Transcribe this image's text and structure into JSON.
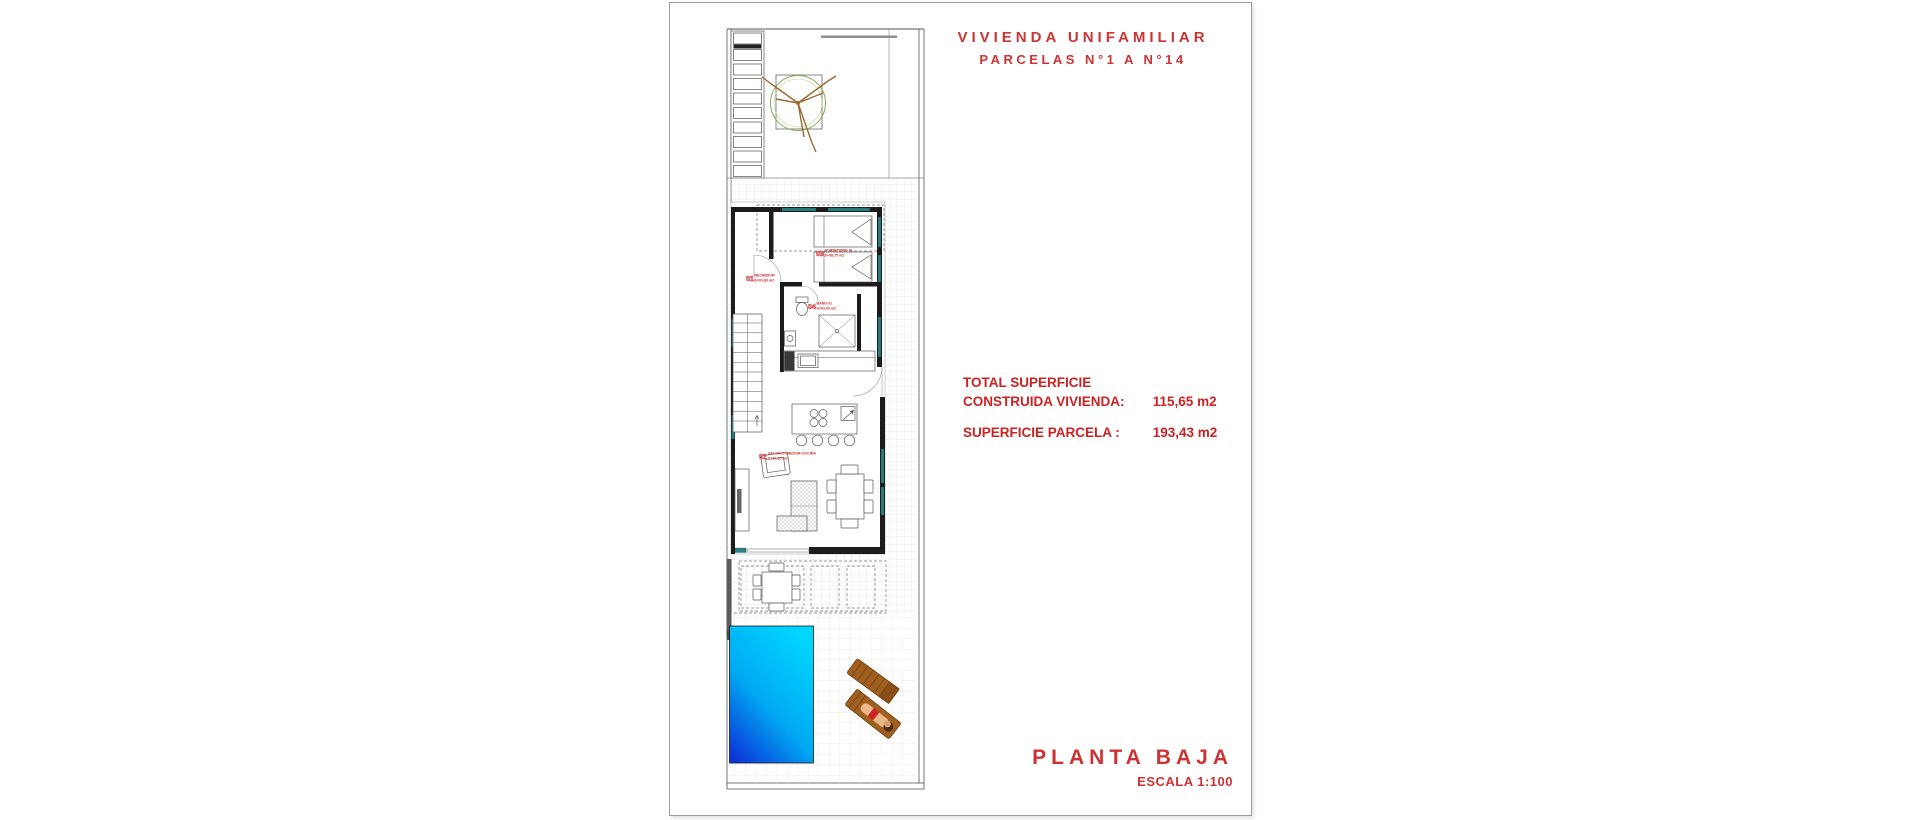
{
  "header": {
    "title_line1": "VIVIENDA UNIFAMILIAR",
    "title_line2": "PARCELAS N°1 A N°14"
  },
  "areas": {
    "total_label_line1": "TOTAL SUPERFICIE",
    "total_label_line2": "CONSTRUIDA VIVIENDA:",
    "total_value": "115,65 m2",
    "parcel_label": "SUPERFICIE PARCELA :",
    "parcel_value": "193,43 m2"
  },
  "footer": {
    "plan_name": "PLANTA BAJA",
    "scale": "ESCALA 1:100"
  },
  "plan": {
    "rooms": [
      {
        "num": "01",
        "name": "RECIBIDOR",
        "area": "S=03,80 m2"
      },
      {
        "num": "02",
        "name": "SALON-COMEDOR-COCINA",
        "area": "S=37,35 m2"
      },
      {
        "num": "03",
        "name": "DORMITORIO 01",
        "area": "S=08,75 m2"
      },
      {
        "num": "04",
        "name": "BAÑO 01",
        "area": "S=03,00 m2"
      }
    ],
    "colors": {
      "red_text": "#cc3333",
      "wall": "#1c1c1c",
      "window_teal": "#2a8082",
      "pool_light": "#00d6ff",
      "pool_dark": "#0a35d8",
      "tree_green": "#84ad52",
      "branch_brown": "#9b6a33",
      "lounger_brown": "#a05f1e",
      "tile_grid": "#d6d6d6"
    }
  }
}
